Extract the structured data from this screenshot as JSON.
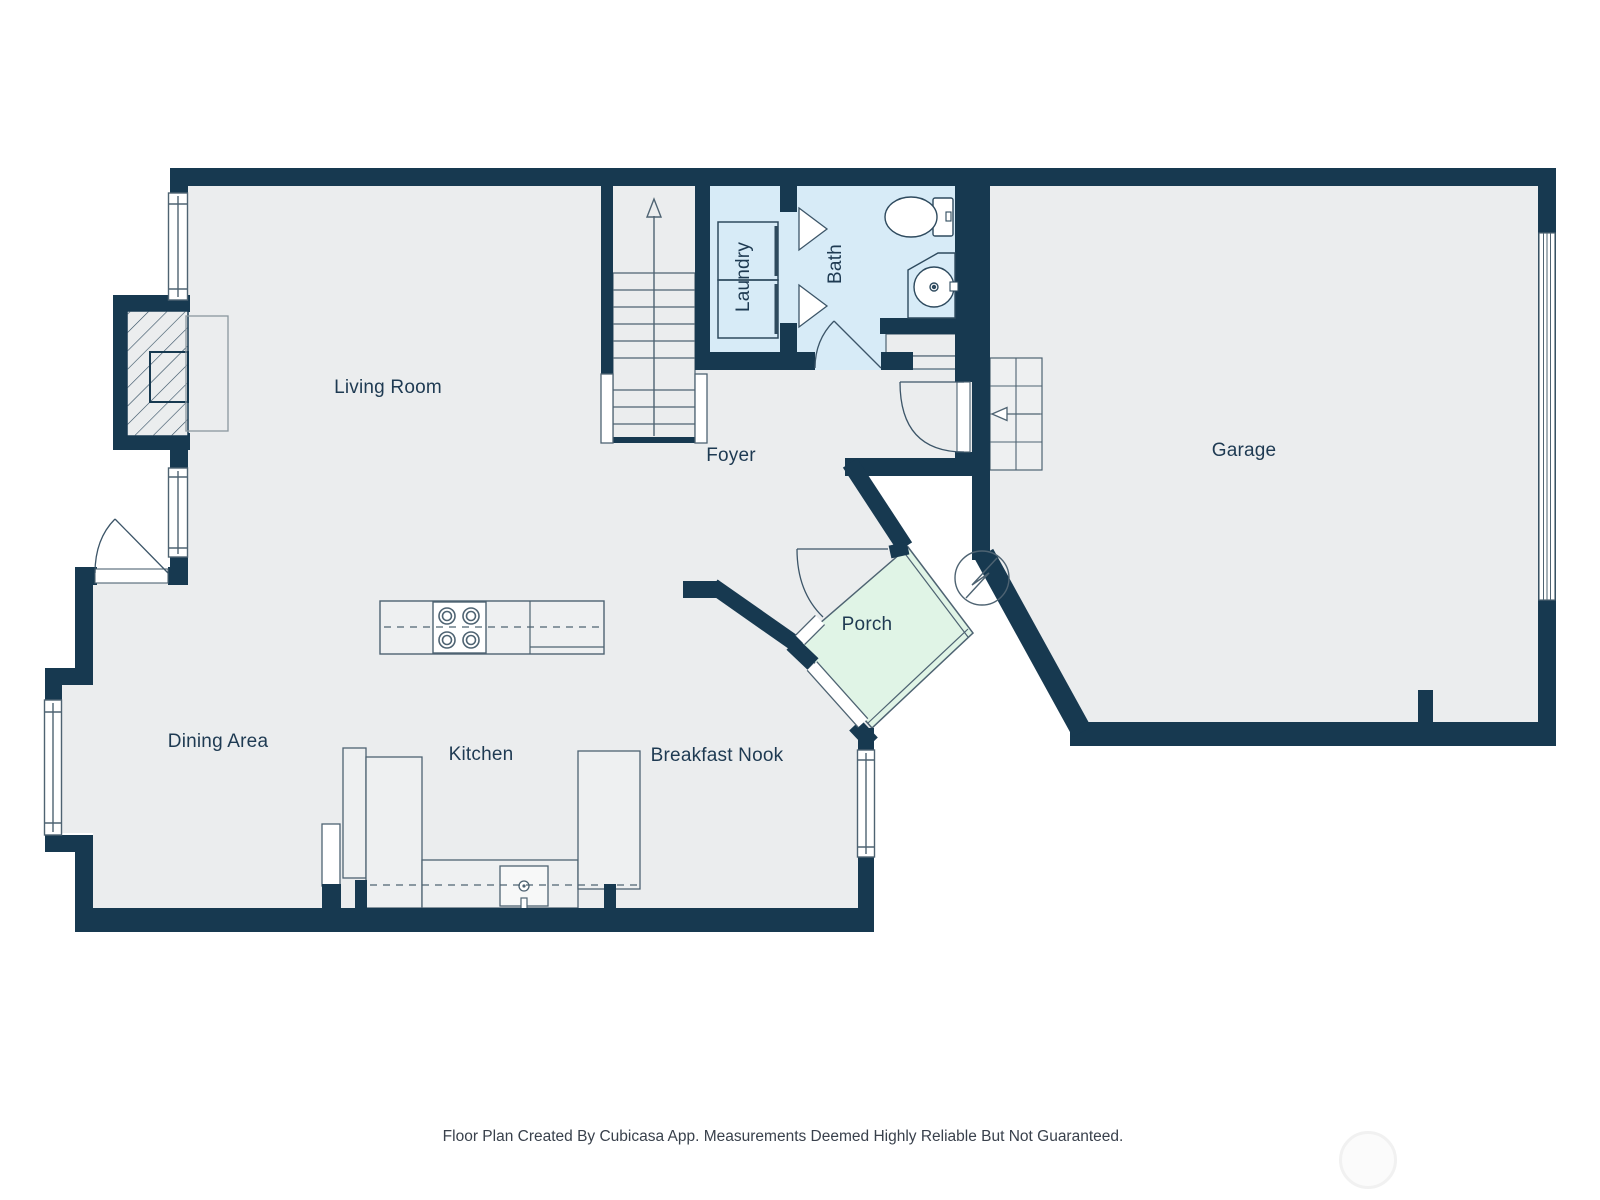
{
  "floor_plan": {
    "footer": "Floor Plan Created By Cubicasa App. Measurements Deemed Highly Reliable But Not Guaranteed.",
    "rooms": [
      {
        "id": "living-room",
        "label": "Living Room"
      },
      {
        "id": "foyer",
        "label": "Foyer"
      },
      {
        "id": "garage",
        "label": "Garage"
      },
      {
        "id": "porch",
        "label": "Porch"
      },
      {
        "id": "dining-area",
        "label": "Dining Area"
      },
      {
        "id": "kitchen",
        "label": "Kitchen"
      },
      {
        "id": "breakfast-nook",
        "label": "Breakfast Nook"
      },
      {
        "id": "laundry",
        "label": "Laundry"
      },
      {
        "id": "bath",
        "label": "Bath"
      }
    ],
    "colors": {
      "wall": "#173950",
      "floor": "#ebedee",
      "wet_room": "#d7ebf7",
      "porch": "#e0f4e6",
      "fixture_line": "#4e6372",
      "label": "#1e3a52",
      "footer_text": "#39414c"
    },
    "fixtures": [
      "fireplace",
      "stairs-up-arrow",
      "washer-dryer",
      "toilet",
      "sink-vanity",
      "stove-4-burner",
      "kitchen-sink",
      "refrigerator",
      "water-heater",
      "garage-door",
      "garage-steps",
      "entry-doors",
      "windows"
    ]
  }
}
